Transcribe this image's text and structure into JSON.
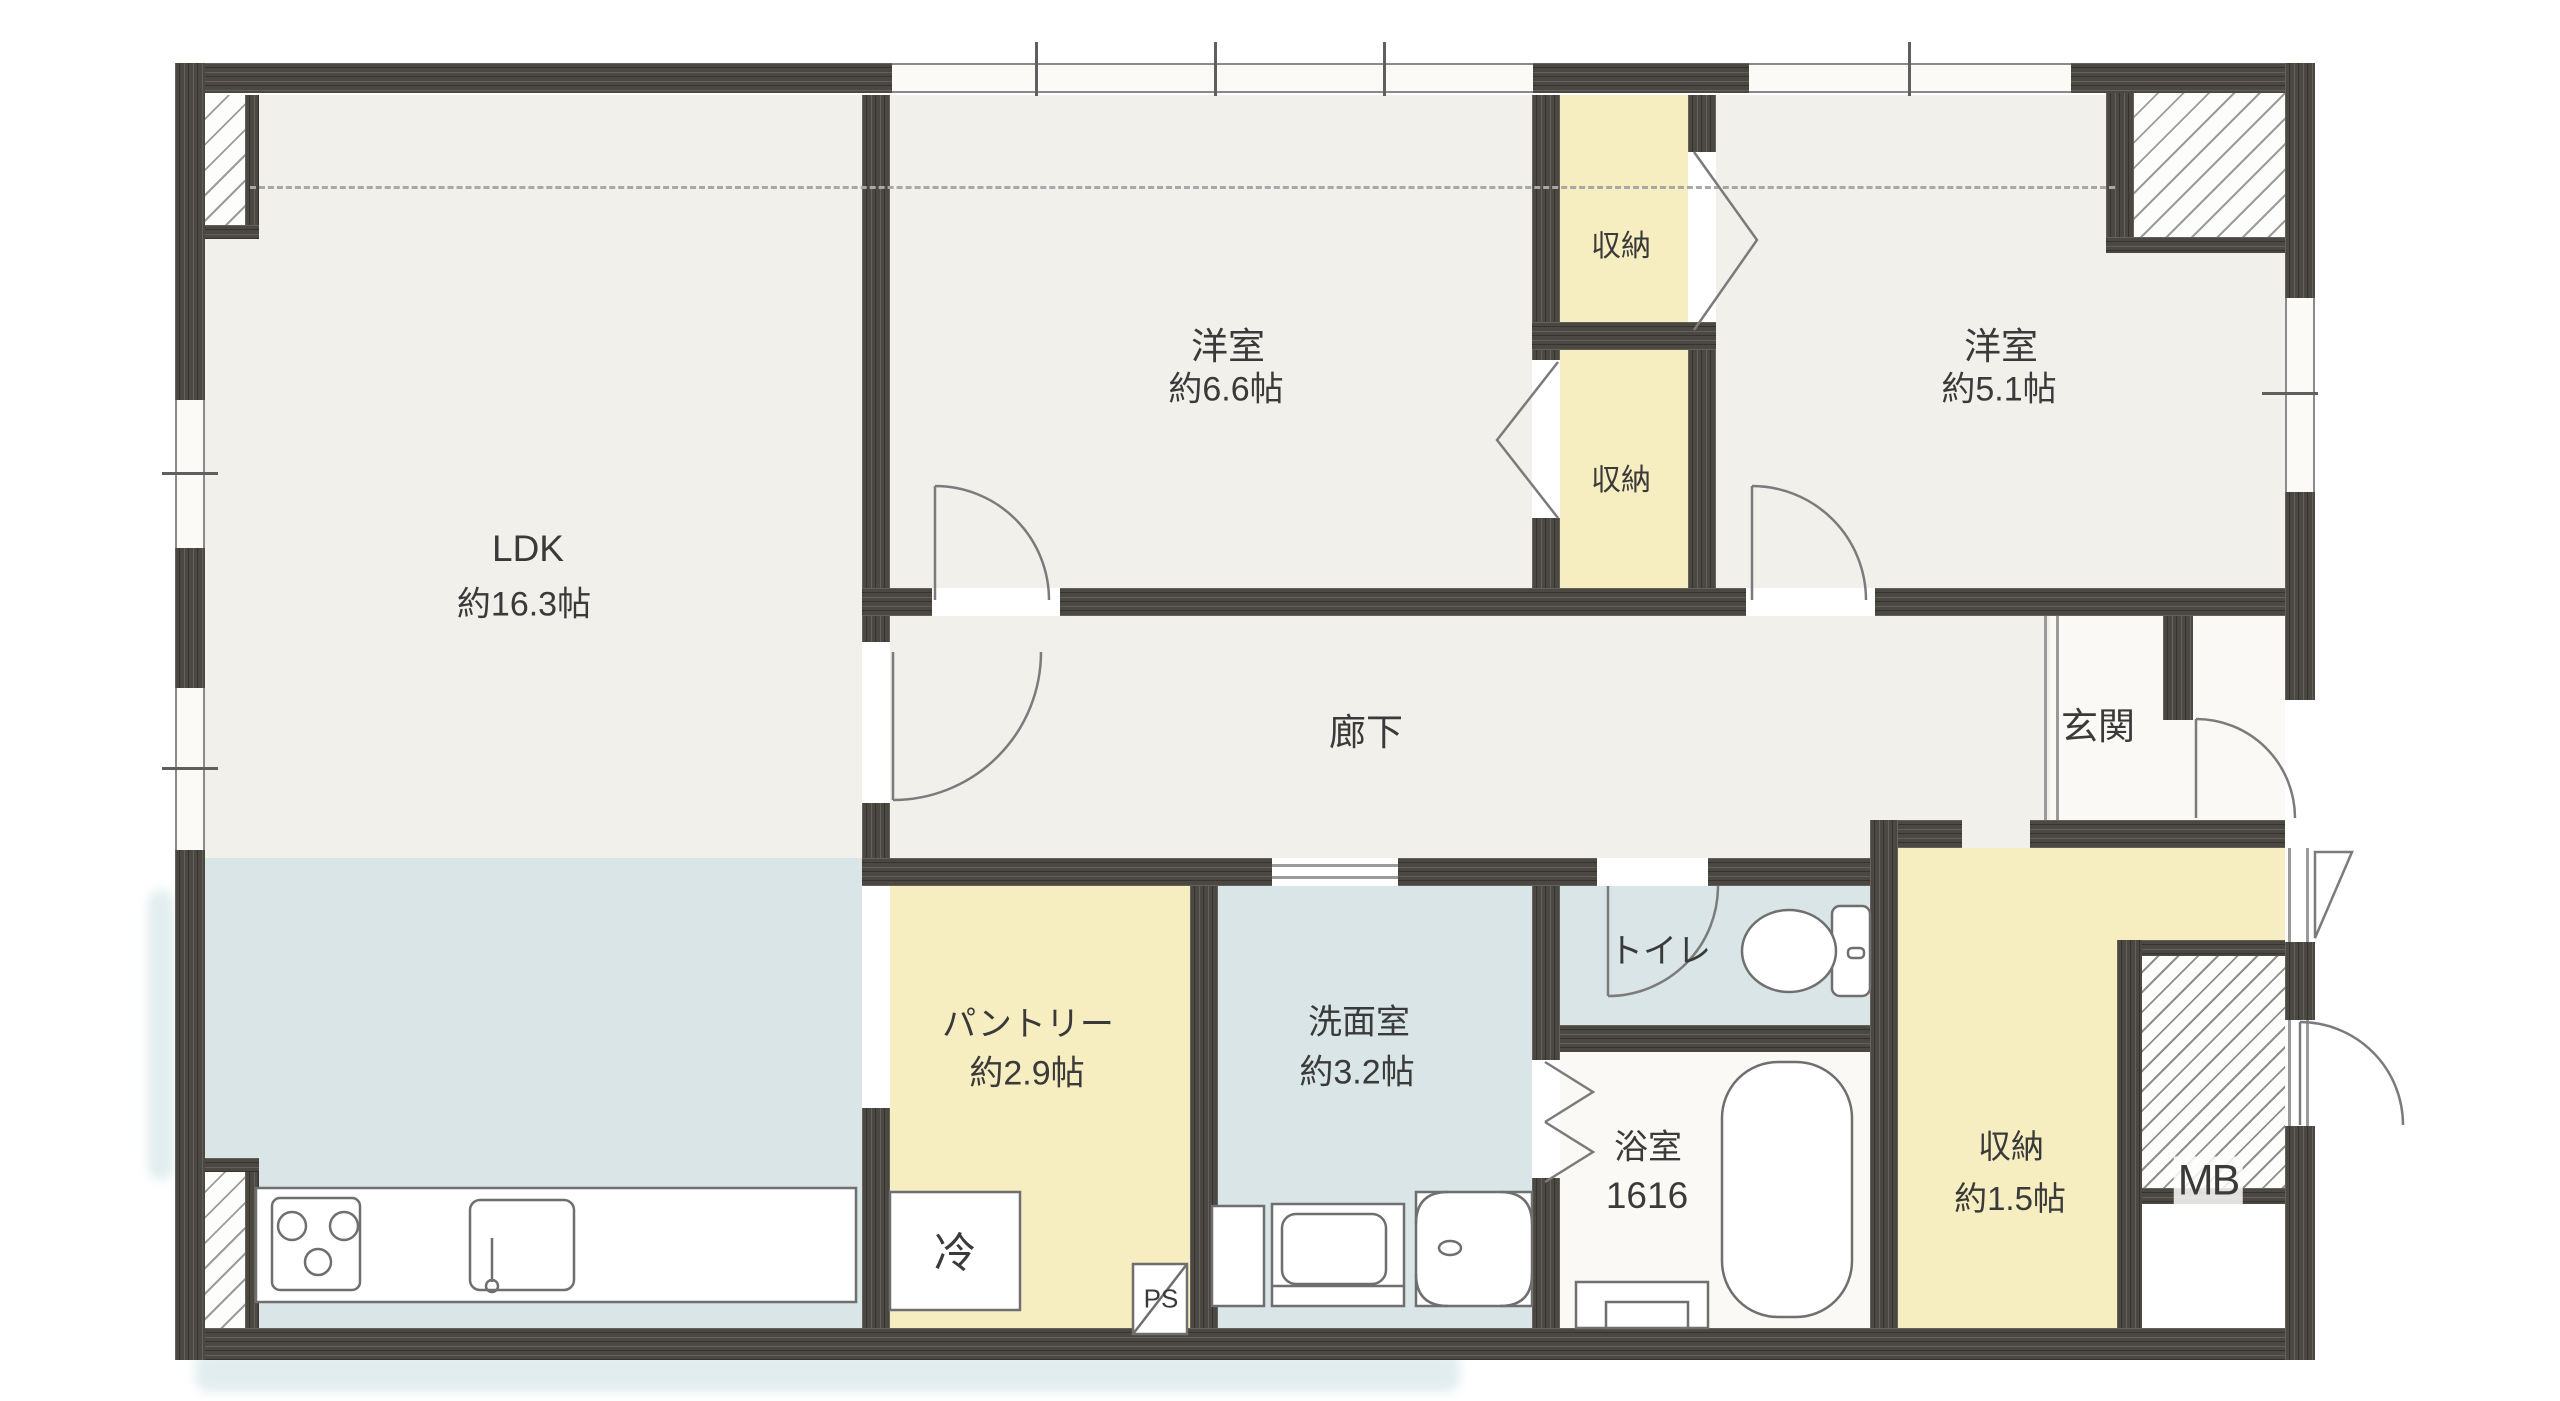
{
  "plan": {
    "type": "apartment-floor-plan",
    "rooms": {
      "ldk": {
        "name": "LDK",
        "size": "約16.3帖"
      },
      "bedroom_66": {
        "name": "洋室",
        "size": "約6.6帖"
      },
      "bedroom_51": {
        "name": "洋室",
        "size": "約5.1帖"
      },
      "closet_upper": {
        "name": "収納"
      },
      "closet_lower": {
        "name": "収納"
      },
      "hallway": {
        "name": "廊下"
      },
      "entrance": {
        "name": "玄関"
      },
      "pantry": {
        "name": "パントリー",
        "size": "約2.9帖"
      },
      "washroom": {
        "name": "洗面室",
        "size": "約3.2帖"
      },
      "toilet": {
        "name": "トイレ"
      },
      "bathroom": {
        "name": "浴室",
        "size": "1616"
      },
      "storage": {
        "name": "収納",
        "size": "約1.5帖"
      },
      "meter_box": {
        "name": "MB"
      },
      "refrigerator": {
        "name": "冷"
      },
      "pipe_space": {
        "name": "PS"
      }
    },
    "colors": {
      "wall": "#4b4741",
      "floor_main": "#f2f0ea",
      "floor_wet": "#d9e5e6",
      "floor_storage": "#f6eec0",
      "floor_entrance": "#faf9f5",
      "symbol_line": "#777777"
    }
  }
}
